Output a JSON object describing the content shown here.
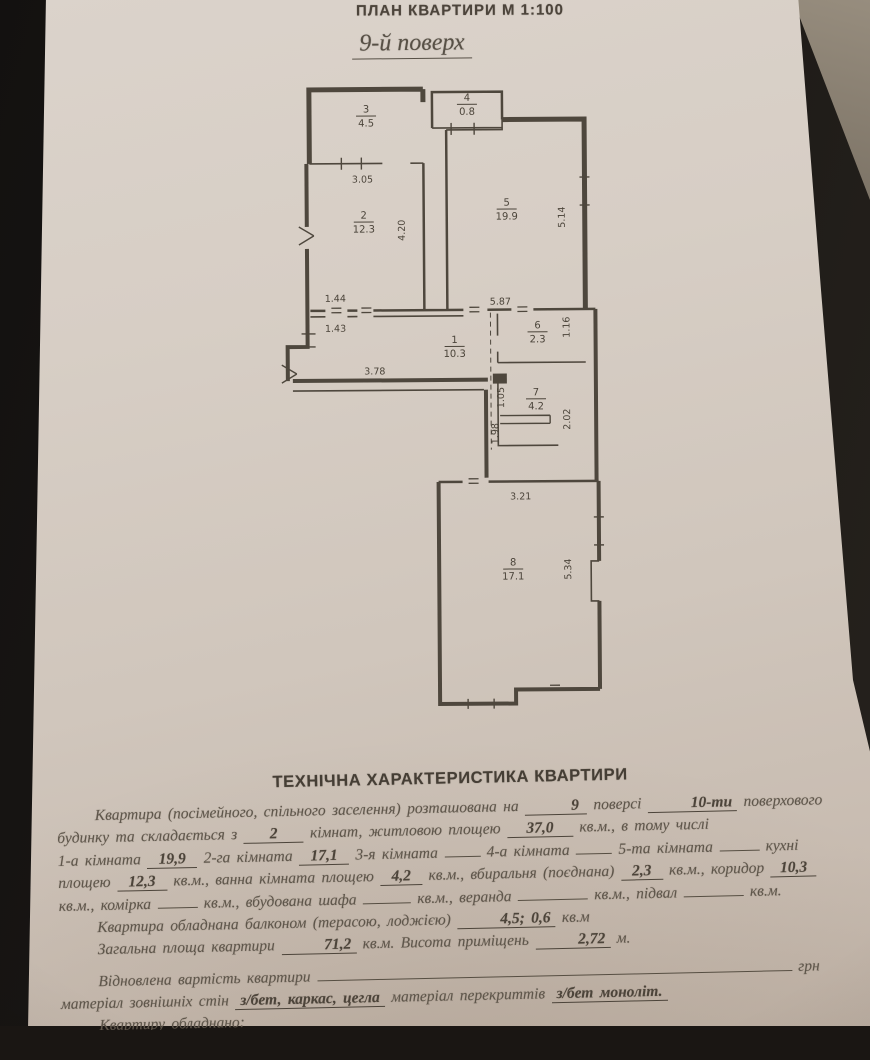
{
  "photo": {
    "background_color": "#1a1613",
    "paper_color": "#d3c9bf",
    "ink_color": "#4c443a"
  },
  "header": {
    "title": "ПЛАН КВАРТИРИ М 1:100",
    "floor": "9-й поверх"
  },
  "plan": {
    "rooms": [
      {
        "n": "3",
        "a": "4.5",
        "x": 120,
        "y": 34
      },
      {
        "n": "4",
        "a": "0.8",
        "x": 221,
        "y": 23
      },
      {
        "n": "2",
        "a": "12.3",
        "x": 117,
        "y": 140
      },
      {
        "n": "5",
        "a": "19.9",
        "x": 260,
        "y": 128
      },
      {
        "n": "1",
        "a": "10.3",
        "x": 207,
        "y": 265
      },
      {
        "n": "6",
        "a": "2.3",
        "x": 290,
        "y": 251
      },
      {
        "n": "7",
        "a": "4.2",
        "x": 288,
        "y": 318
      },
      {
        "n": "8",
        "a": "17.1",
        "x": 264,
        "y": 488
      }
    ],
    "dims": [
      {
        "v": "3.05",
        "x": 116,
        "y": 104,
        "r": 0
      },
      {
        "v": "4.20",
        "x": 158,
        "y": 152,
        "r": -90
      },
      {
        "v": "1.44",
        "x": 88,
        "y": 223,
        "r": 0
      },
      {
        "v": "1.43",
        "x": 88,
        "y": 253,
        "r": 0
      },
      {
        "v": "3.78",
        "x": 127,
        "y": 296,
        "r": 0
      },
      {
        "v": "5.87",
        "x": 253,
        "y": 227,
        "r": 0
      },
      {
        "v": "5.14",
        "x": 318,
        "y": 140,
        "r": -90
      },
      {
        "v": "1.16",
        "x": 322,
        "y": 250,
        "r": -90
      },
      {
        "v": "1.05",
        "x": 256,
        "y": 320,
        "r": -90
      },
      {
        "v": "2.02",
        "x": 322,
        "y": 342,
        "r": -90
      },
      {
        "v": "1.98",
        "x": 250,
        "y": 356,
        "r": -90
      },
      {
        "v": "3.21",
        "x": 272,
        "y": 422,
        "r": 0
      },
      {
        "v": "5.34",
        "x": 322,
        "y": 492,
        "r": -90
      }
    ]
  },
  "tech": {
    "heading": "ТЕХНІЧНА ХАРАКТЕРИСТИКА КВАРТИРИ",
    "lines": [
      {
        "indent": 38,
        "segs": [
          {
            "t": "Квартира (посімейного, спільного заселення) розташована на"
          },
          {
            "v": "9",
            "w": 52
          },
          {
            "t": "поверсі"
          },
          {
            "v": "10-ти",
            "w": 66
          },
          {
            "t": "поверхового"
          }
        ]
      },
      {
        "indent": 0,
        "segs": [
          {
            "t": "будинку  та  складається з"
          },
          {
            "v": "2",
            "w": 50
          },
          {
            "t": "кімнат,  житловою площею"
          },
          {
            "v": "37,0",
            "w": 56
          },
          {
            "t": "кв.м.,  в тому числі"
          }
        ]
      },
      {
        "indent": 0,
        "segs": [
          {
            "t": "1-а кімната"
          },
          {
            "v": "19,9",
            "w": 40
          },
          {
            "t": "2-га кімната"
          },
          {
            "v": "17,1",
            "w": 40
          },
          {
            "t": "3-я кімната"
          },
          {
            "b": 36
          },
          {
            "t": "4-а кімната"
          },
          {
            "b": 36
          },
          {
            "t": "5-та кімната"
          },
          {
            "b": 40
          },
          {
            "t": "кухні"
          }
        ]
      },
      {
        "indent": 0,
        "segs": [
          {
            "t": "площею"
          },
          {
            "v": "12,3",
            "w": 40
          },
          {
            "t": "кв.м., ванна кімната площею"
          },
          {
            "v": "4,2",
            "w": 32
          },
          {
            "t": "кв.м., вбиральня (поєднана)"
          },
          {
            "v": "2,3",
            "w": 32
          },
          {
            "t": "кв.м., коридор"
          },
          {
            "v": "10,3",
            "w": 36
          }
        ]
      },
      {
        "indent": 0,
        "segs": [
          {
            "t": "кв.м., комірка"
          },
          {
            "b": 40
          },
          {
            "t": "кв.м., вбудована шафа"
          },
          {
            "b": 48
          },
          {
            "t": "кв.м., веранда"
          },
          {
            "b": 70
          },
          {
            "t": "кв.м., підвал"
          },
          {
            "b": 60
          },
          {
            "t": "кв.м."
          }
        ]
      },
      {
        "indent": 38,
        "segs": [
          {
            "t": "Квартира обладнана балконом (терасою, лоджією)"
          },
          {
            "v": "4,5; 0,6",
            "w": 62
          },
          {
            "t": "кв.м"
          }
        ]
      },
      {
        "indent": 38,
        "segs": [
          {
            "t": "Загальна площа квартири"
          },
          {
            "v": "71,2",
            "w": 46
          },
          {
            "t": "кв.м. Висота приміщень"
          },
          {
            "v": "2,72",
            "w": 40
          },
          {
            "t": "м."
          }
        ]
      },
      {
        "gap": true,
        "indent": 38,
        "segs": [
          {
            "t": "Відновлена вартість квартири"
          },
          {
            "b": 475
          },
          {
            "t": "грн"
          }
        ]
      },
      {
        "indent": 0,
        "segs": [
          {
            "t": "матеріал зовнішніх стін"
          },
          {
            "v": "з/бет, каркас, цегла",
            "w": 0
          },
          {
            "t": "матеріал перекриттів"
          },
          {
            "v": "з/бет моноліт.",
            "w": 0
          }
        ]
      },
      {
        "indent": 38,
        "segs": [
          {
            "t": "Квартиру обладнано:"
          }
        ]
      },
      {
        "indent": 0,
        "segs": [
          {
            "t": "водопроводом (холодним, гарячим), каналізацією, електроосвітленням"
          }
        ]
      }
    ]
  }
}
